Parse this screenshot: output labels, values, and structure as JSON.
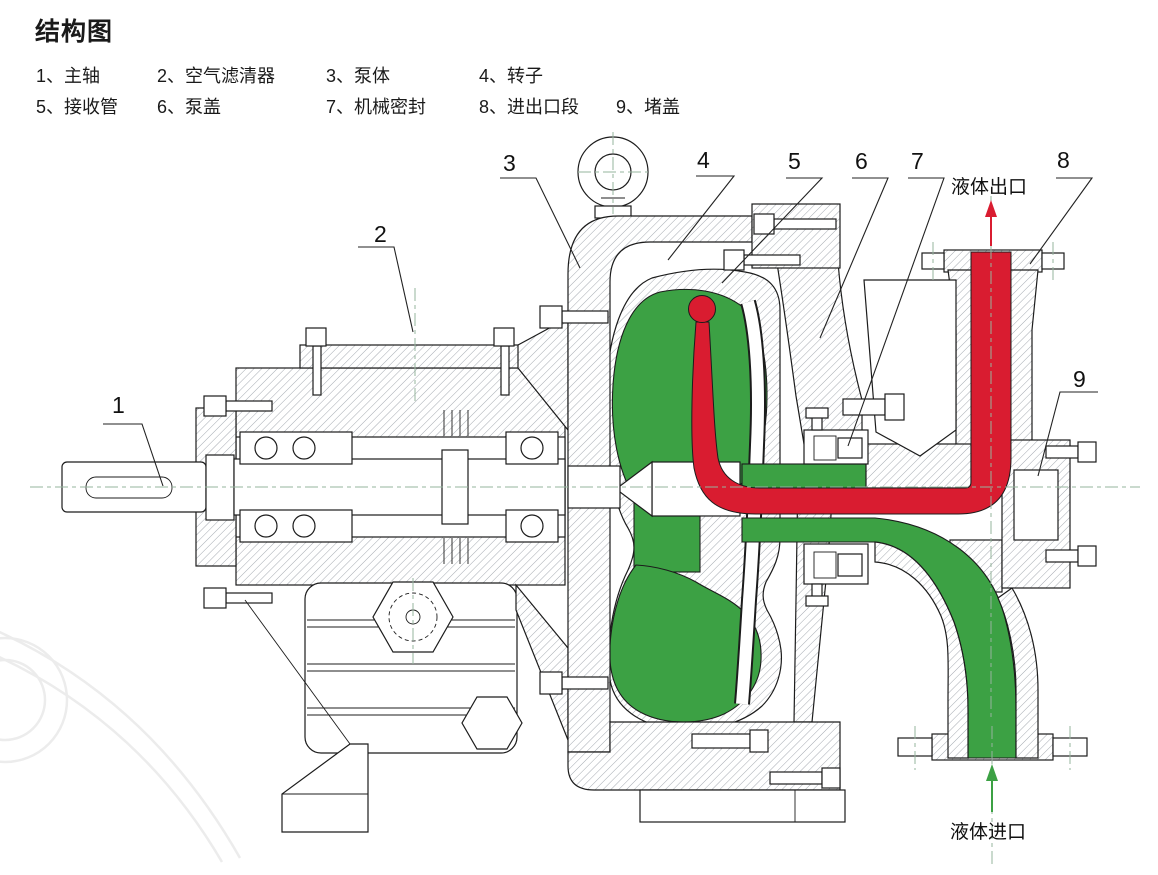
{
  "title": "结构图",
  "legend": {
    "row1": [
      "1、主轴",
      "2、空气滤清器",
      "3、泵体",
      "4、转子"
    ],
    "row2": [
      "5、接收管",
      "6、泵盖",
      "7、机械密封",
      "8、进出口段",
      "9、堵盖"
    ]
  },
  "parts": [
    {
      "num": "1",
      "name": "主轴"
    },
    {
      "num": "2",
      "name": "空气滤清器"
    },
    {
      "num": "3",
      "name": "泵体"
    },
    {
      "num": "4",
      "name": "转子"
    },
    {
      "num": "5",
      "name": "接收管"
    },
    {
      "num": "6",
      "name": "泵盖"
    },
    {
      "num": "7",
      "name": "机械密封"
    },
    {
      "num": "8",
      "name": "进出口段"
    },
    {
      "num": "9",
      "name": "堵盖"
    }
  ],
  "callouts": [
    "1",
    "2",
    "3",
    "4",
    "5",
    "6",
    "7",
    "8",
    "9"
  ],
  "flow_labels": {
    "outlet": "液体出口",
    "inlet": "液体进口"
  },
  "colors": {
    "inlet_flow": "#3ca144",
    "outlet_flow": "#d91c30",
    "line": "#1c1c1c",
    "hatch": "#9ba1a8",
    "centerline": "#96b49e"
  }
}
